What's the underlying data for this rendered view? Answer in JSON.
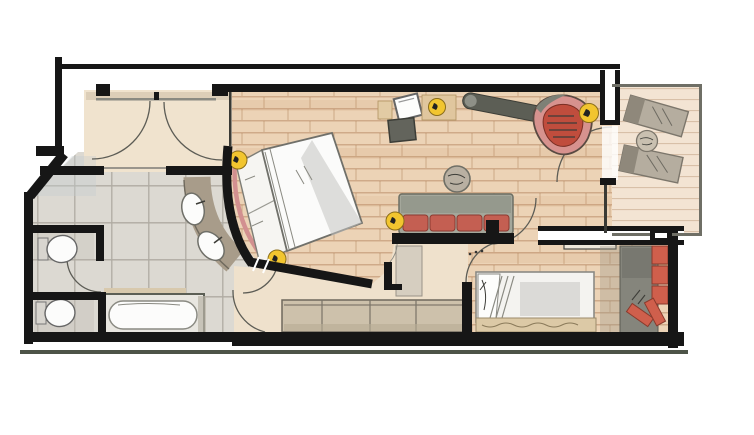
{
  "meta": {
    "type": "architectural-floor-plan",
    "style": "hand-drawn watercolor hotel suite plan",
    "width_px": 754,
    "height_px": 435
  },
  "palette": {
    "paper": "#ffffff",
    "wood_floor": "#ecd3b6",
    "wood_line": "#b5825a",
    "tile_floor": "#dcd9d2",
    "hall_floor": "#f0e3ce",
    "passage_floor": "#efe1cc",
    "balcony_floor": "#f3e4d3",
    "wall_black": "#161616",
    "outer_line": "#4d5448",
    "bed_linen": "#fbfbfa",
    "pillow_white": "#f6f5f2",
    "headboard_pink": "#d29090",
    "sofa_frame_gray": "#a4a79b",
    "cushion_red": "#c45f52",
    "armchair_red": "#c04d3d",
    "armchair_shell_pink": "#d7928e",
    "lamp_yellow": "#f2c52f",
    "vanity_gray": "#a89c8a",
    "fixture_white": "#fcfcfb",
    "wardrobe_red": "#cf5f4c",
    "wardrobe_gray": "#85857c",
    "sideboard_tan": "#cdc1ab",
    "lounger_gray": "#b5ad9f",
    "shelf_cream": "#eee7da",
    "cabinet_gray": "#d6cec0",
    "stone_table_gray": "#b9b0a2",
    "stool_dark": "#63645c",
    "bench_dark": "#5c5e55",
    "mattress_white": "#f4f3f0",
    "bedframe_tan": "#dcc9a6"
  },
  "rooms": {
    "entry_hall": {
      "door_swings": 2
    },
    "bathroom": {
      "wc_rooms": 2,
      "toilets": 2,
      "bathtub": 1,
      "vanity_sinks": 2,
      "shower_area": 1
    },
    "bedroom": {
      "double_bed": 1,
      "reading_lamps": 2,
      "curved_wall": 1
    },
    "living_area": {
      "sofa_cushions": 4,
      "floor_lamps": 3,
      "round_side_table": 1,
      "desk_chair": 1,
      "stool": 1,
      "bench": 1,
      "red_armchair": 1
    },
    "second_bedroom": {
      "single_bed": 1,
      "wardrobe": 1,
      "wall_shelf": 1,
      "sideboard_sections": 4
    },
    "balcony": {
      "sun_loungers": 2,
      "side_table": 1
    }
  }
}
